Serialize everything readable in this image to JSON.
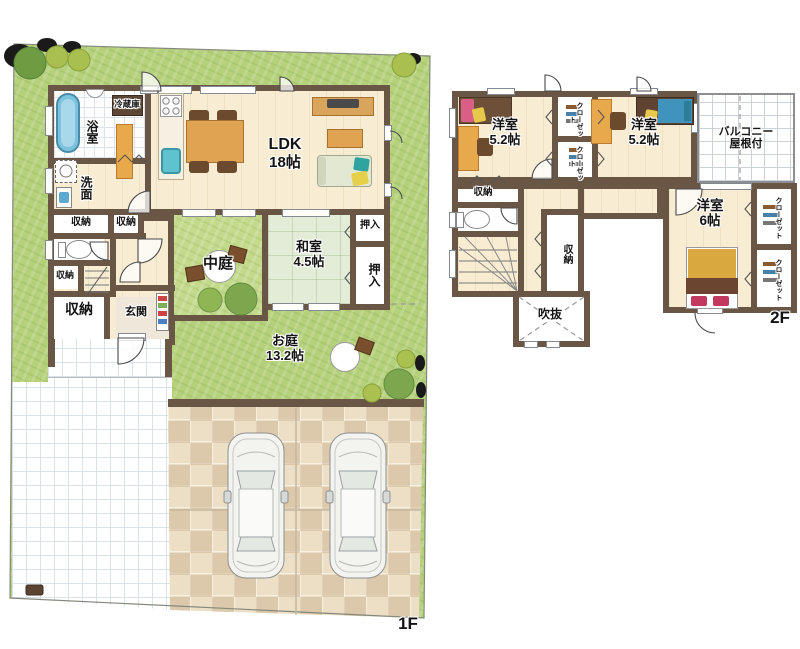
{
  "floor1": {
    "floor_label": "1F",
    "ldk_name": "LDK",
    "ldk_size": "18帖",
    "bath": "浴室",
    "washroom": "洗面",
    "fridge": "冷蔵庫",
    "storage": "収納",
    "entrance": "玄関",
    "courtyard": "中庭",
    "japanese_room": "和室",
    "japanese_room_size": "4.5帖",
    "oshiire": "押入",
    "garden": "お庭",
    "garden_size": "13.2帖"
  },
  "floor2": {
    "floor_label": "2F",
    "western_room": "洋室",
    "room_size_52": "5.2帖",
    "room_size_6": "6帖",
    "closet": "クローゼット",
    "balcony": "バルコニー",
    "balcony_roof": "屋根付",
    "storage": "収納",
    "void": "吹抜"
  },
  "colors": {
    "wall": "#6a5645",
    "floor": "#f8ecd2",
    "grass": "#b5d17c",
    "tatami": "#e2ecd6",
    "accent_wood": "#e0a352"
  }
}
